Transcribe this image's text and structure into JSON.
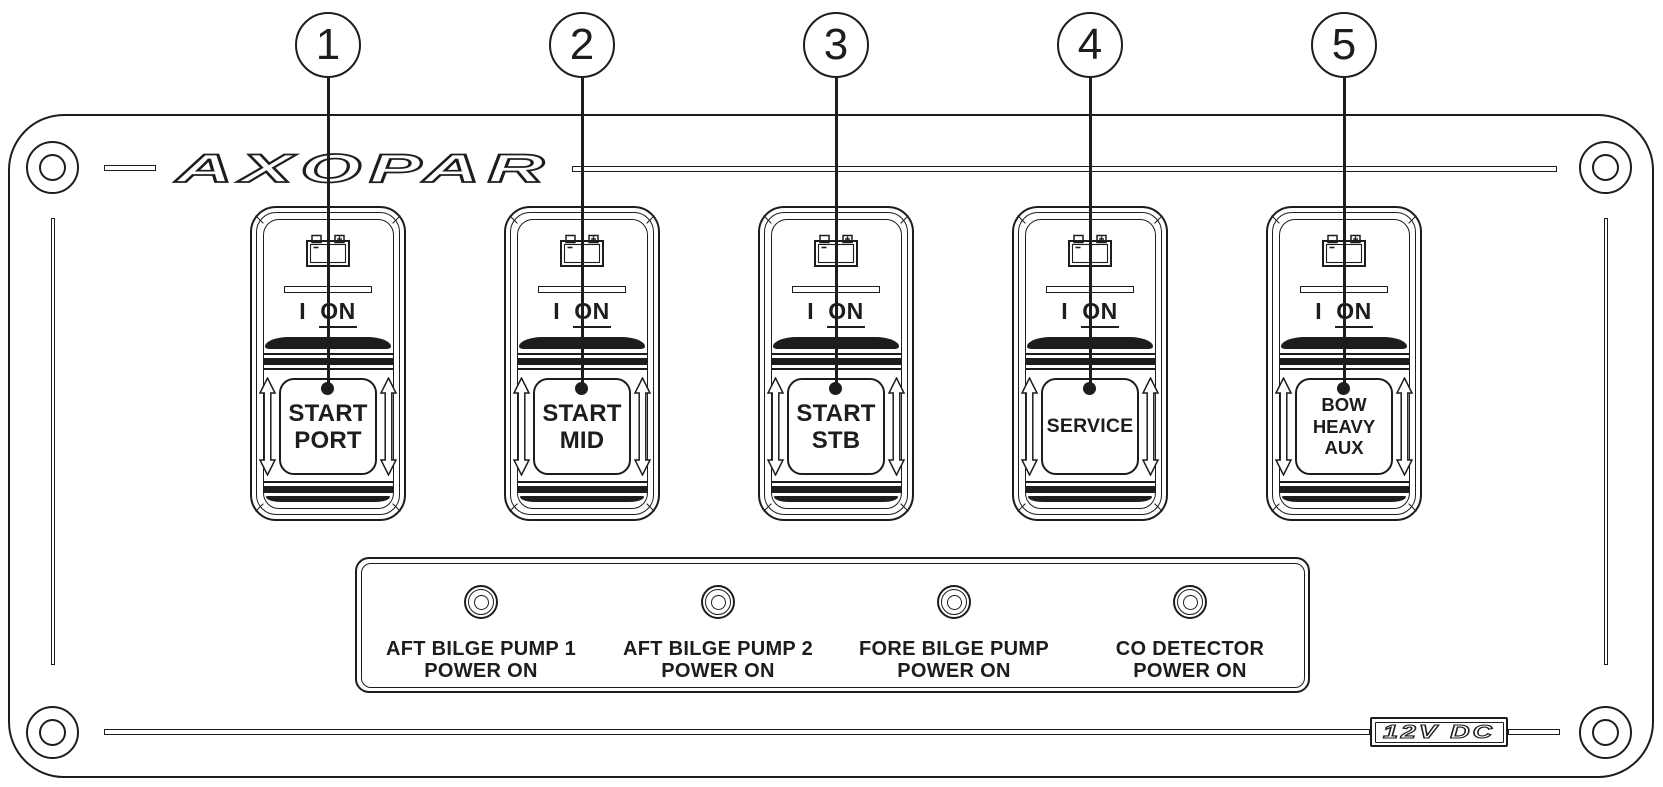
{
  "panel": {
    "brand_logo": "AXOPAR",
    "voltage_label": "12V DC"
  },
  "colors": {
    "line": "#1d1d1b",
    "background": "#ffffff"
  },
  "callouts": [
    {
      "number": "1"
    },
    {
      "number": "2"
    },
    {
      "number": "3"
    },
    {
      "number": "4"
    },
    {
      "number": "5"
    }
  ],
  "switch_common": {
    "position_i": "I",
    "position_on": "ON",
    "icons": [
      "battery-icon",
      "up-down-arrow-icon"
    ]
  },
  "switches": [
    {
      "label": "START\nPORT"
    },
    {
      "label": "START\nMID"
    },
    {
      "label": "START\nSTB"
    },
    {
      "label": "SERVICE"
    },
    {
      "label": "BOW\nHEAVY\nAUX"
    }
  ],
  "indicators": [
    {
      "label": "AFT BILGE PUMP 1\nPOWER ON"
    },
    {
      "label": "AFT BILGE PUMP 2\nPOWER ON"
    },
    {
      "label": "FORE BILGE PUMP\nPOWER ON"
    },
    {
      "label": "CO DETECTOR\nPOWER ON"
    }
  ]
}
